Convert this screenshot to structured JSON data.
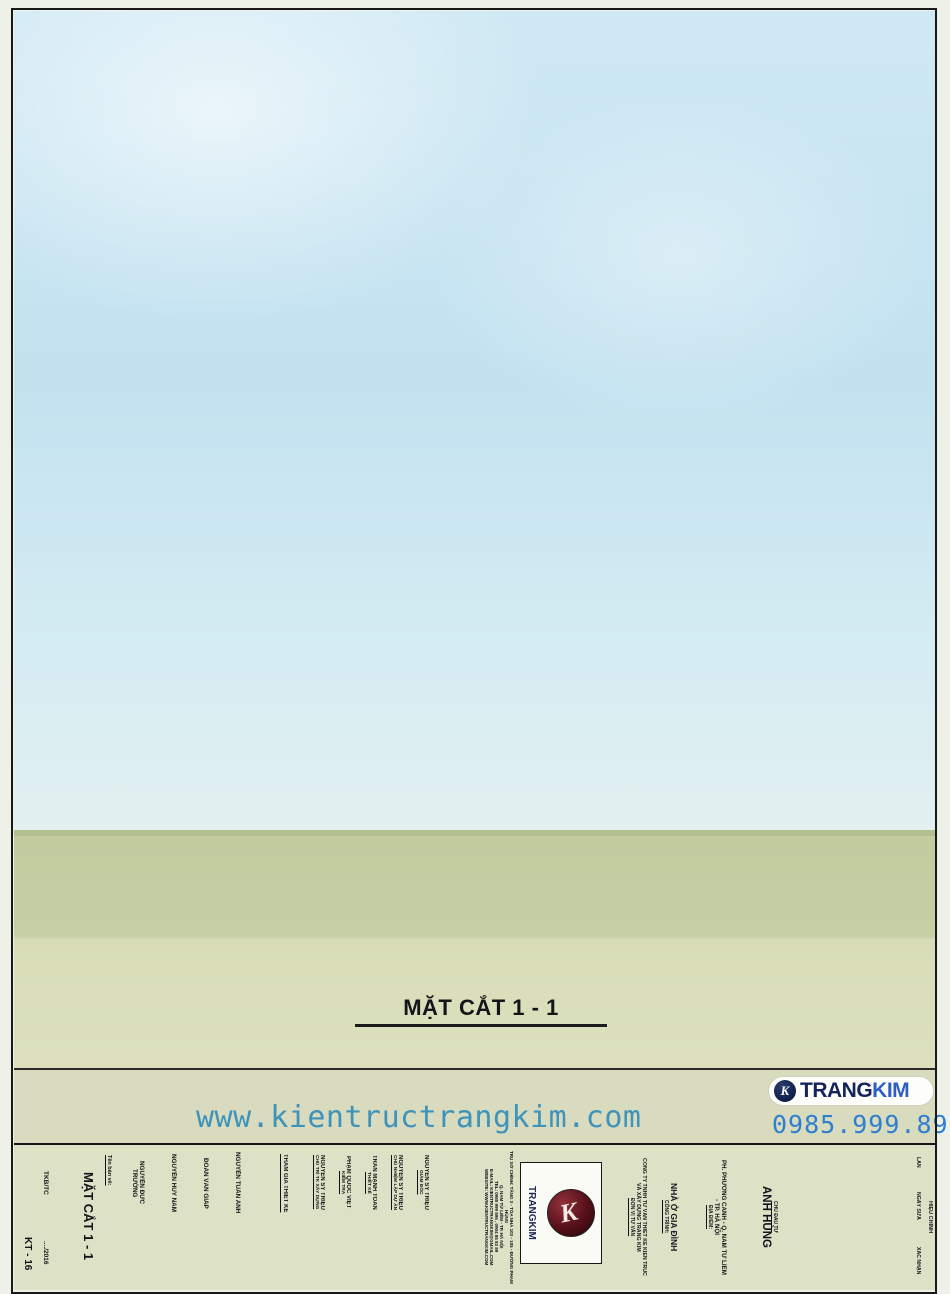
{
  "sheet": {
    "levels_left": [
      {
        "name": "MÁI 2",
        "elev": "+25.000"
      },
      {
        "name": "MÁI 1",
        "elev": "+23.400"
      },
      {
        "name": "T. TUM",
        "elev": "+20.100"
      },
      {
        "name": "TẦNG 6",
        "elev": "+16.800"
      },
      {
        "name": "TẦNG 5",
        "elev": "+13.500"
      },
      {
        "name": "TẦNG 4",
        "elev": "+10.200"
      },
      {
        "name": "TẦNG 3",
        "elev": "+6.900"
      },
      {
        "name": "TẦNG 2",
        "elev": "+3.600"
      },
      {
        "name": "TẦNG 1",
        "elev": "±0.000"
      },
      {
        "name": "VỈA HÈ",
        "elev": "-1.500"
      }
    ],
    "levels_right": [
      {
        "name": "MÁI 2",
        "elev": "+25.000"
      },
      {
        "name": "MÁI 1",
        "elev": "+23.400"
      },
      {
        "name": "T. TUM",
        "elev": "+20.100"
      },
      {
        "name": "TẦNG 6",
        "elev": "+16.800"
      },
      {
        "name": "TẦNG 5",
        "elev": "+13.500"
      },
      {
        "name": "TẦNG 4",
        "elev": "+10.200"
      },
      {
        "name": "TẦNG 3",
        "elev": "+6.900"
      },
      {
        "name": "TẦNG 2",
        "elev": "+3.600"
      },
      {
        "name": "TẦNG 1",
        "elev": "±0.000"
      },
      {
        "name": "T. BÁN HẦM",
        "elev": "-2.700"
      }
    ],
    "dims_left": [
      "1600",
      "3300",
      "3300",
      "3300",
      "3300",
      "3300",
      "3300",
      "3600",
      "1500"
    ],
    "dims_right": [
      "1600",
      "3300",
      "3300",
      "3300",
      "3300",
      "3300",
      "3300",
      "3600",
      "2700"
    ],
    "overall_left": "25000",
    "overall_right": "25000",
    "bottom": {
      "end_left": "110",
      "segments": [
        "5080",
        "6200",
        "5980",
        "2520"
      ],
      "end_right": "110",
      "overall": "20000"
    },
    "grids": [
      "1",
      "2",
      "3",
      "4",
      "5"
    ],
    "title": "MẶT CẮT 1 - 1"
  },
  "watermark": {
    "url": "www.kientructrangkim.com",
    "logo_trang": "TRANG",
    "logo_kim": "KIM",
    "logo_k": "K",
    "phone": "0985.999.895"
  },
  "titleblock": {
    "sheet_no": "KT - 16",
    "stage": "TKB/TC",
    "date": "..../2016",
    "name_label": "Tên bản vẽ:",
    "drawing_name": "MẶT CẮT 1 - 1",
    "participants_label": "THAM GIA THIẾT KẾ",
    "participants": [
      "NGUYỄN ĐỨC TRƯỜNG",
      "NGUYỄN HUY NAM",
      "ĐOÀN VĂN GIÁP",
      "NGUYỄN TUẤN ANH"
    ],
    "roles": [
      {
        "role": "CHỦ TRÌ TK XÂY DỰNG",
        "name": "NGUYỄN SỸ TRIỆU"
      },
      {
        "role": "KIỂM TRA",
        "name": "PHẠM QUỐC VIỆT"
      },
      {
        "role": "THIẾT KẾ",
        "name": "TRẦN MẠNH TOÀN"
      },
      {
        "role": "CHỦ NHIỆM LẬP DỰ ÁN",
        "name": "NGUYỄN SỸ TRIỆU"
      },
      {
        "role": "GIÁM ĐỐC",
        "name": "NGUYỄN SỸ TRIỆU"
      }
    ],
    "company_info": [
      "TRỤ SỞ CHÍNH: TẦNG 3 - TÒA NHÀ 103 - 105 - ĐƯỜNG PHẠM HÙNG",
      "Q. NAM TỪ LIÊM - TP. HÀ NỘI",
      "TEL: 0985 999 895 , 0904 85 83 89",
      "E-MAIL: KIENTRUCTRANGKIM@GMAIL.COM",
      "WEBSITE: WWW.KIENTRUCTRANGKIM.COM"
    ],
    "logo_text": "TRANGKIM",
    "consultant_label": "ĐƠN VỊ TƯ VẤN",
    "consultant_line1": "CÔNG TY TNHH TƯ VẤN THIẾT KẾ KIẾN TRÚC",
    "consultant_line2": "VÀ XÂY DỰNG TRANG KIM",
    "project_label": "CÔNG TRÌNH:",
    "project_name": "NHÀ Ở GIA ĐÌNH",
    "location_label": "ĐỊA ĐIỂM:",
    "location_line1": "PH. PHƯƠNG CANH - Q. NAM TỪ LIÊM",
    "location_line2": "- TP. HÀ NỘI",
    "client_label": "CHỦ ĐẦU TƯ",
    "client_name": "ANH HÙNG",
    "rev": {
      "col_turn": "LẦN",
      "col_date": "NGÀY SỬA",
      "col_confirm": "XÁC NHẬN",
      "side": "HIỆU CHỈNH",
      "dash": "-"
    }
  }
}
